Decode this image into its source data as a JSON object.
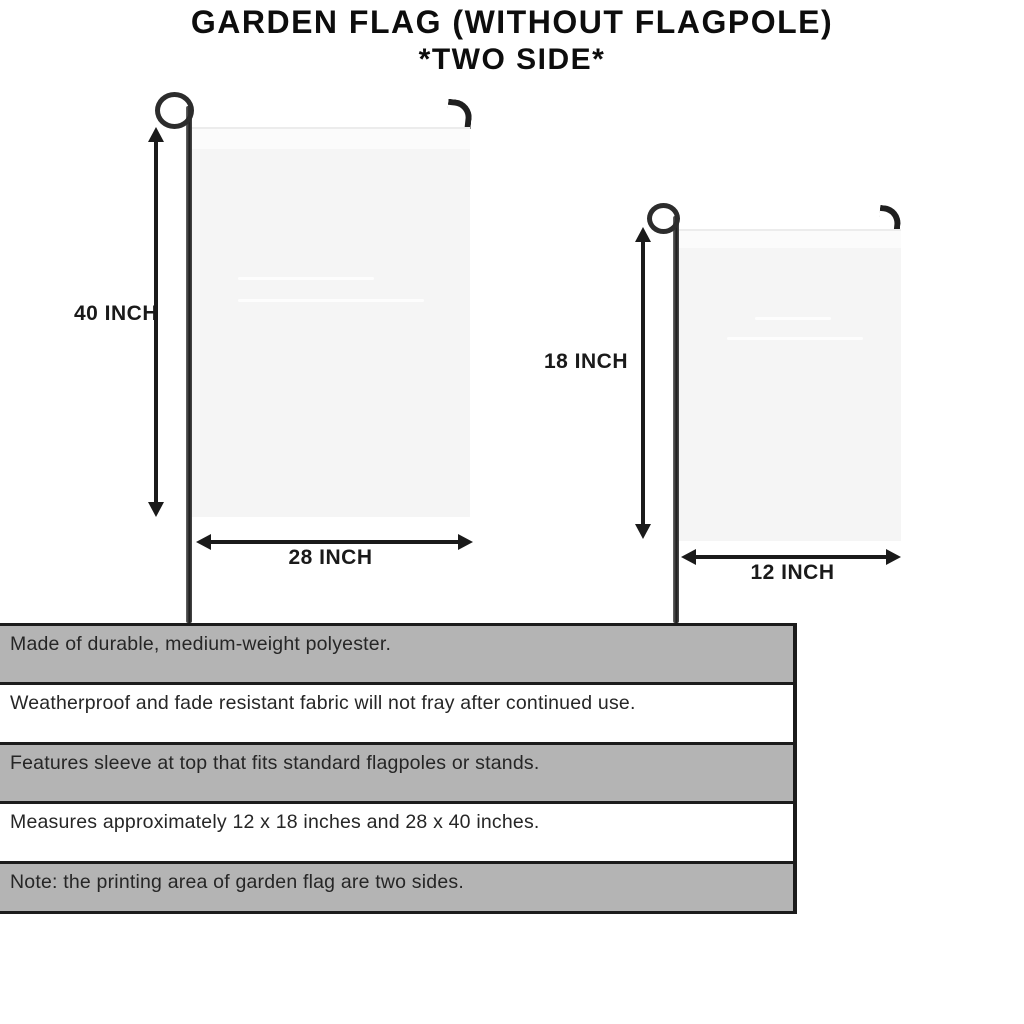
{
  "title": {
    "line1": "GARDEN FLAG (WITHOUT FLAGPOLE)",
    "line2": "*TWO SIDE*"
  },
  "flags": {
    "large": {
      "height_label": "40 INCH",
      "width_label": "28 INCH"
    },
    "small": {
      "height_label": "18 INCH",
      "width_label": "12 INCH"
    }
  },
  "features": [
    "Made of durable, medium-weight polyester.",
    "Weatherproof and fade resistant fabric will not fray after continued use.",
    "Features sleeve at top that fits standard flagpoles or stands.",
    "Measures approximately 12 x 18 inches and 28 x 40 inches.",
    "Note: the printing area of garden flag are two sides."
  ],
  "colors": {
    "background": "#ffffff",
    "title_text": "#0d0d0d",
    "dimension_text": "#1a1a1a",
    "pole_dark": "#262626",
    "flag_fill": "#f5f5f5",
    "flag_sleeve": "#fbfbfb",
    "stripe_gray": "#b4b4b4",
    "stripe_white": "#ffffff",
    "stripe_border": "#1c1c1c",
    "feature_text": "#262626"
  }
}
